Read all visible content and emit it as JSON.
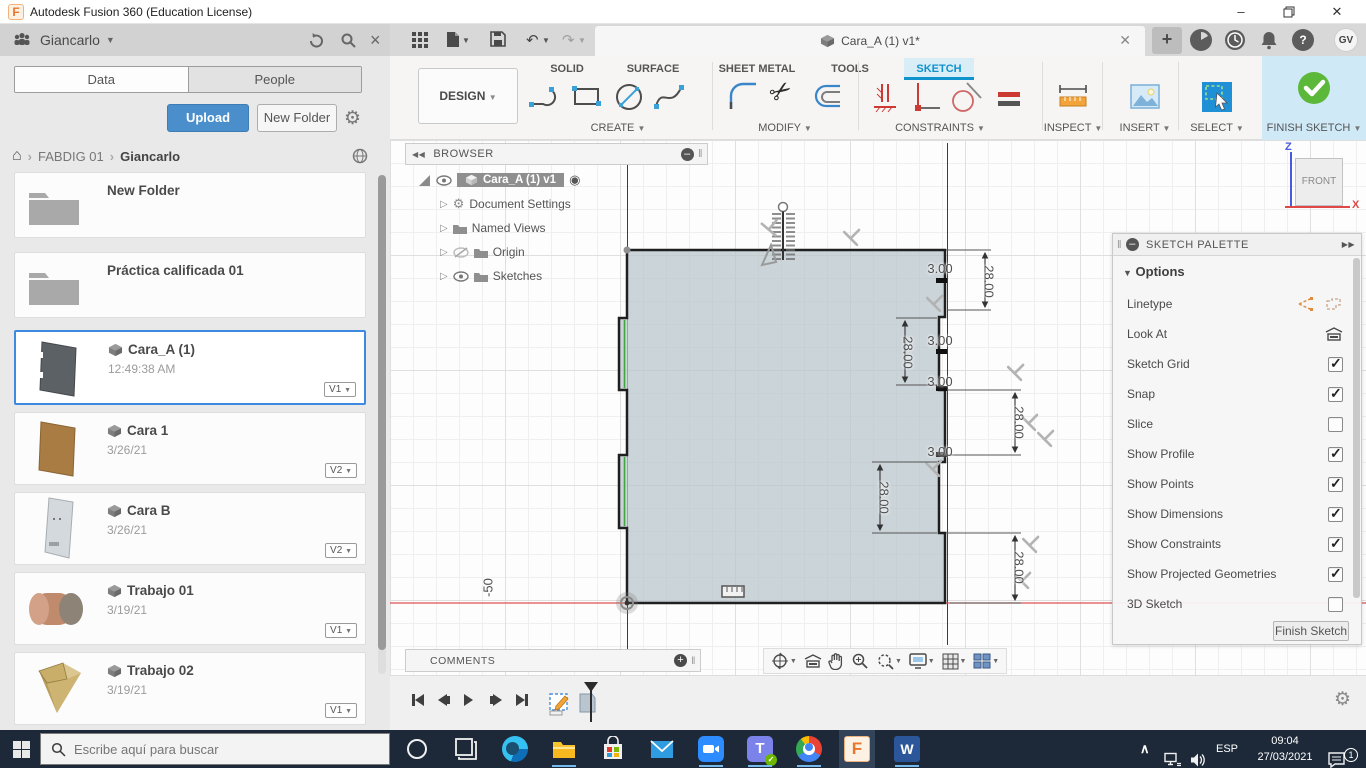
{
  "window": {
    "title": "Autodesk Fusion 360 (Education License)"
  },
  "data_panel": {
    "user": "Giancarlo",
    "tabs": [
      {
        "label": "Data"
      },
      {
        "label": "People"
      }
    ],
    "active_tab": "Data",
    "upload_label": "Upload",
    "new_folder_label": "New Folder",
    "breadcrumb": {
      "root": "FABDIG 01",
      "current": "Giancarlo"
    },
    "items": [
      {
        "type": "folder",
        "name": "New Folder"
      },
      {
        "type": "folder",
        "name": "Práctica calificada 01"
      },
      {
        "type": "file",
        "name": "Cara_A (1)",
        "meta": "12:49:38 AM",
        "version": "V1",
        "selected": true
      },
      {
        "type": "file",
        "name": "Cara 1",
        "meta": "3/26/21",
        "version": "V2"
      },
      {
        "type": "file",
        "name": "Cara B",
        "meta": "3/26/21",
        "version": "V2"
      },
      {
        "type": "file",
        "name": "Trabajo 01",
        "meta": "3/19/21",
        "version": "V1"
      },
      {
        "type": "file",
        "name": "Trabajo 02",
        "meta": "3/19/21",
        "version": "V1"
      }
    ]
  },
  "toolbar": {
    "design_label": "DESIGN",
    "tabs": [
      {
        "label": "SOLID"
      },
      {
        "label": "SURFACE"
      },
      {
        "label": "SHEET METAL"
      },
      {
        "label": "TOOLS"
      },
      {
        "label": "SKETCH"
      }
    ],
    "active_tab": "SKETCH",
    "groups": [
      {
        "label": "CREATE"
      },
      {
        "label": "MODIFY"
      },
      {
        "label": "CONSTRAINTS"
      },
      {
        "label": "INSPECT"
      },
      {
        "label": "INSERT"
      },
      {
        "label": "SELECT"
      }
    ],
    "finish_label": "FINISH SKETCH"
  },
  "document": {
    "tab_title": "Cara_A (1) v1*",
    "account_initials": "GV"
  },
  "browser": {
    "title": "BROWSER",
    "root": "Cara_A (1) v1",
    "nodes": [
      {
        "label": "Document Settings"
      },
      {
        "label": "Named Views"
      },
      {
        "label": "Origin"
      },
      {
        "label": "Sketches"
      }
    ]
  },
  "canvas": {
    "dimensions": [
      {
        "value": "28.00"
      },
      {
        "value": "28.00"
      },
      {
        "value": "28.00"
      },
      {
        "value": "28.00"
      },
      {
        "value": "28.00"
      },
      {
        "value": "3.00"
      },
      {
        "value": "3.00"
      },
      {
        "value": "3.00"
      },
      {
        "value": "3.00"
      }
    ],
    "axis_label": "-50",
    "viewcube": {
      "face": "FRONT",
      "axis_z": "Z",
      "axis_x": "X"
    }
  },
  "sketch_palette": {
    "title": "SKETCH PALETTE",
    "section": "Options",
    "rows": [
      {
        "label": "Linetype",
        "control": "icons"
      },
      {
        "label": "Look At",
        "control": "icon"
      },
      {
        "label": "Sketch Grid",
        "control": "checkbox",
        "checked": true
      },
      {
        "label": "Snap",
        "control": "checkbox",
        "checked": true
      },
      {
        "label": "Slice",
        "control": "checkbox",
        "checked": false
      },
      {
        "label": "Show Profile",
        "control": "checkbox",
        "checked": true
      },
      {
        "label": "Show Points",
        "control": "checkbox",
        "checked": true
      },
      {
        "label": "Show Dimensions",
        "control": "checkbox",
        "checked": true
      },
      {
        "label": "Show Constraints",
        "control": "checkbox",
        "checked": true
      },
      {
        "label": "Show Projected Geometries",
        "control": "checkbox",
        "checked": true
      },
      {
        "label": "3D Sketch",
        "control": "checkbox",
        "checked": false
      }
    ],
    "finish_button": "Finish Sketch"
  },
  "comments": {
    "label": "COMMENTS"
  },
  "taskbar": {
    "search_placeholder": "Escribe aquí para buscar",
    "language": "ESP",
    "time": "09:04",
    "date": "27/03/2021",
    "notification_badge": "1"
  },
  "colors": {
    "accent_blue": "#0f93cd",
    "upload_blue": "#4a8fcb",
    "finish_green": "#5cb838",
    "axis_red": "#e05252",
    "axis_green": "#3fa63f"
  }
}
